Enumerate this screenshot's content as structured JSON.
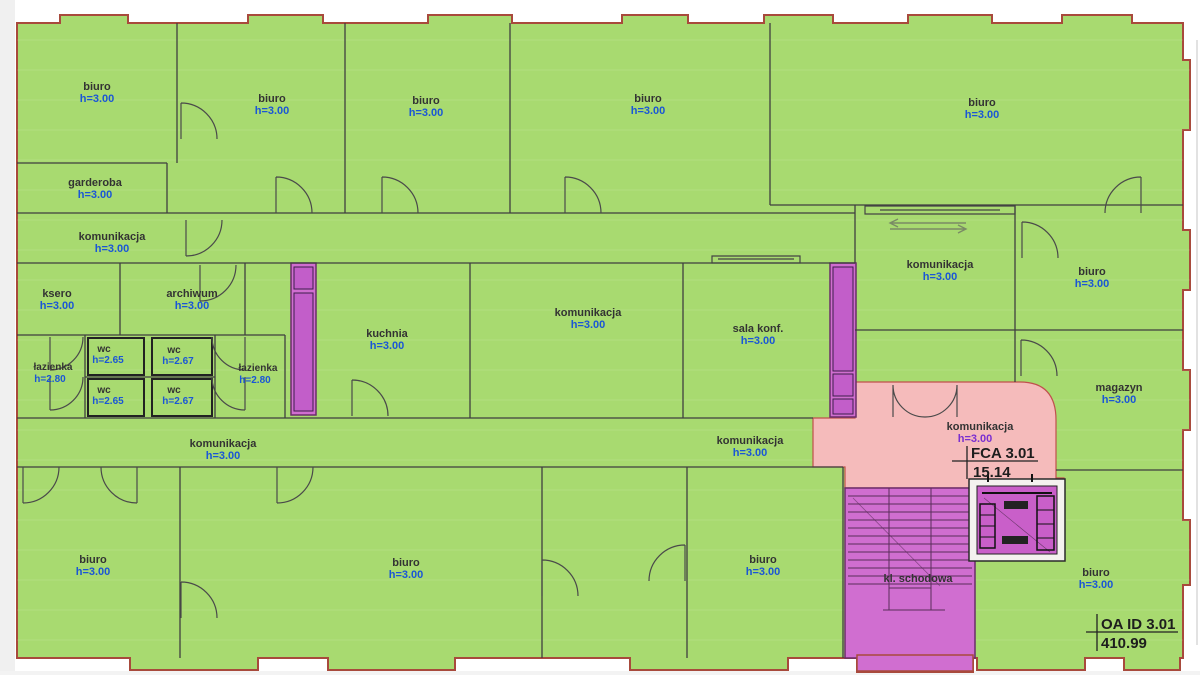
{
  "plan": {
    "rooms": [
      {
        "name": "biuro",
        "h": "h=3.00"
      },
      {
        "name": "biuro",
        "h": "h=3.00"
      },
      {
        "name": "biuro",
        "h": "h=3.00"
      },
      {
        "name": "biuro",
        "h": "h=3.00"
      },
      {
        "name": "biuro",
        "h": "h=3.00"
      },
      {
        "name": "garderoba",
        "h": "h=3.00"
      },
      {
        "name": "komunikacja",
        "h": "h=3.00"
      },
      {
        "name": "ksero",
        "h": "h=3.00"
      },
      {
        "name": "archiwum",
        "h": "h=3.00"
      },
      {
        "name": "wc",
        "h": "h=2.65"
      },
      {
        "name": "wc",
        "h": "h=2.67"
      },
      {
        "name": "łazienka",
        "h": "h=2.80"
      },
      {
        "name": "wc",
        "h": "h=2.65"
      },
      {
        "name": "wc",
        "h": "h=2.67"
      },
      {
        "name": "łazienka",
        "h": "h=2.80"
      },
      {
        "name": "kuchnia",
        "h": "h=3.00"
      },
      {
        "name": "komunikacja",
        "h": "h=3.00"
      },
      {
        "name": "sala konf.",
        "h": "h=3.00"
      },
      {
        "name": "komunikacja",
        "h": "h=3.00"
      },
      {
        "name": "biuro",
        "h": "h=3.00"
      },
      {
        "name": "magazyn",
        "h": "h=3.00"
      },
      {
        "name": "komunikacja",
        "h": "h=3.00"
      },
      {
        "name": "komunikacja",
        "h": "h=3.00"
      },
      {
        "name": "komunikacja",
        "h": "h=3.00"
      },
      {
        "name": "biuro",
        "h": "h=3.00"
      },
      {
        "name": "biuro",
        "h": "h=3.00"
      },
      {
        "name": "biuro",
        "h": "h=3.00"
      },
      {
        "name": "biuro",
        "h": "h=3.00"
      }
    ],
    "stair_label": "kl. schodowa",
    "annotations": {
      "fca": {
        "title": "FCA 3.01",
        "value": "15.14"
      },
      "oa": {
        "title": "OA ID 3.01",
        "value": "410.99"
      }
    },
    "colors": {
      "room_green": "#a8da70",
      "corridor_pink": "#f5bbbb",
      "shaft_magenta": "#d06ed0",
      "shaft_inner": "#c25ec9",
      "outer_wall": "#a84a3c",
      "inner_wall": "#3f3f3f",
      "room_name_text": "#333333",
      "height_text": "#1a56d6",
      "height_text_pink": "#7a2fd0"
    }
  }
}
